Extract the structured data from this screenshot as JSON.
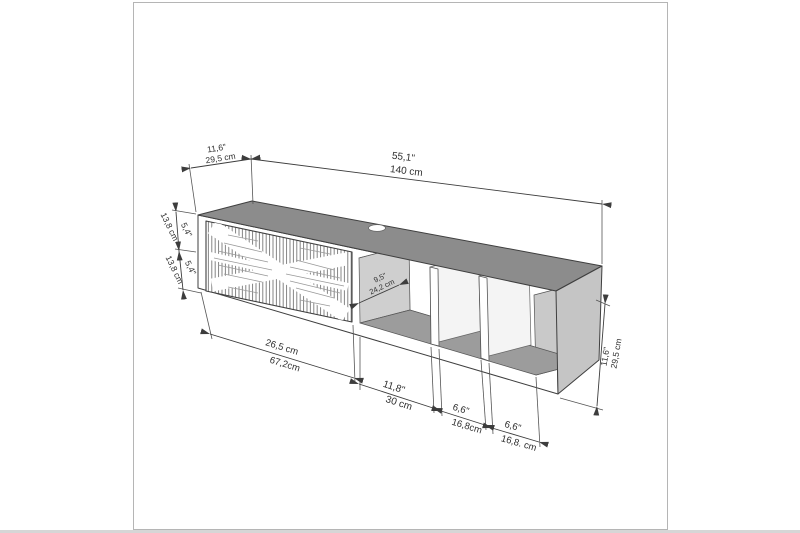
{
  "colors": {
    "page_bg": "#ffffff",
    "figure_border": "#b5b5b5",
    "bottom_strip": "#d6d6d6",
    "line": "#3d3d3d",
    "text": "#2f2f2f",
    "top_face": "#8c8c8c",
    "right_face": "#c5c5c5",
    "inner_wall": "#cfcfcf",
    "inner_wall_right": "#c9c9c9",
    "floor": "#9c9c9c",
    "divider_face": "#f4f4f4",
    "front_face": "#ffffff"
  },
  "dims": {
    "top_width": {
      "primary": "55,1\"",
      "secondary": "140 cm"
    },
    "top_depth": {
      "primary": "11,6\"",
      "secondary": "29,5 cm"
    },
    "left_upper": {
      "primary": "5,4\"",
      "secondary": "13,8 cm"
    },
    "left_lower": {
      "primary": "5,4\"",
      "secondary": "13,8 cm"
    },
    "inner_depth": {
      "primary": "9,5\"",
      "secondary": "24,2 cm"
    },
    "right_height": {
      "primary": "11,6\"",
      "secondary": "29,5 cm"
    },
    "bottom_1": {
      "primary": "26,5 cm",
      "secondary": "67,2cm"
    },
    "bottom_2": {
      "primary": "11,8\"",
      "secondary": "30 cm"
    },
    "bottom_3": {
      "primary": "6,6\"",
      "secondary": "16,8cm"
    },
    "bottom_4": {
      "primary": "6,6\"",
      "secondary": "16,8. cm"
    }
  }
}
